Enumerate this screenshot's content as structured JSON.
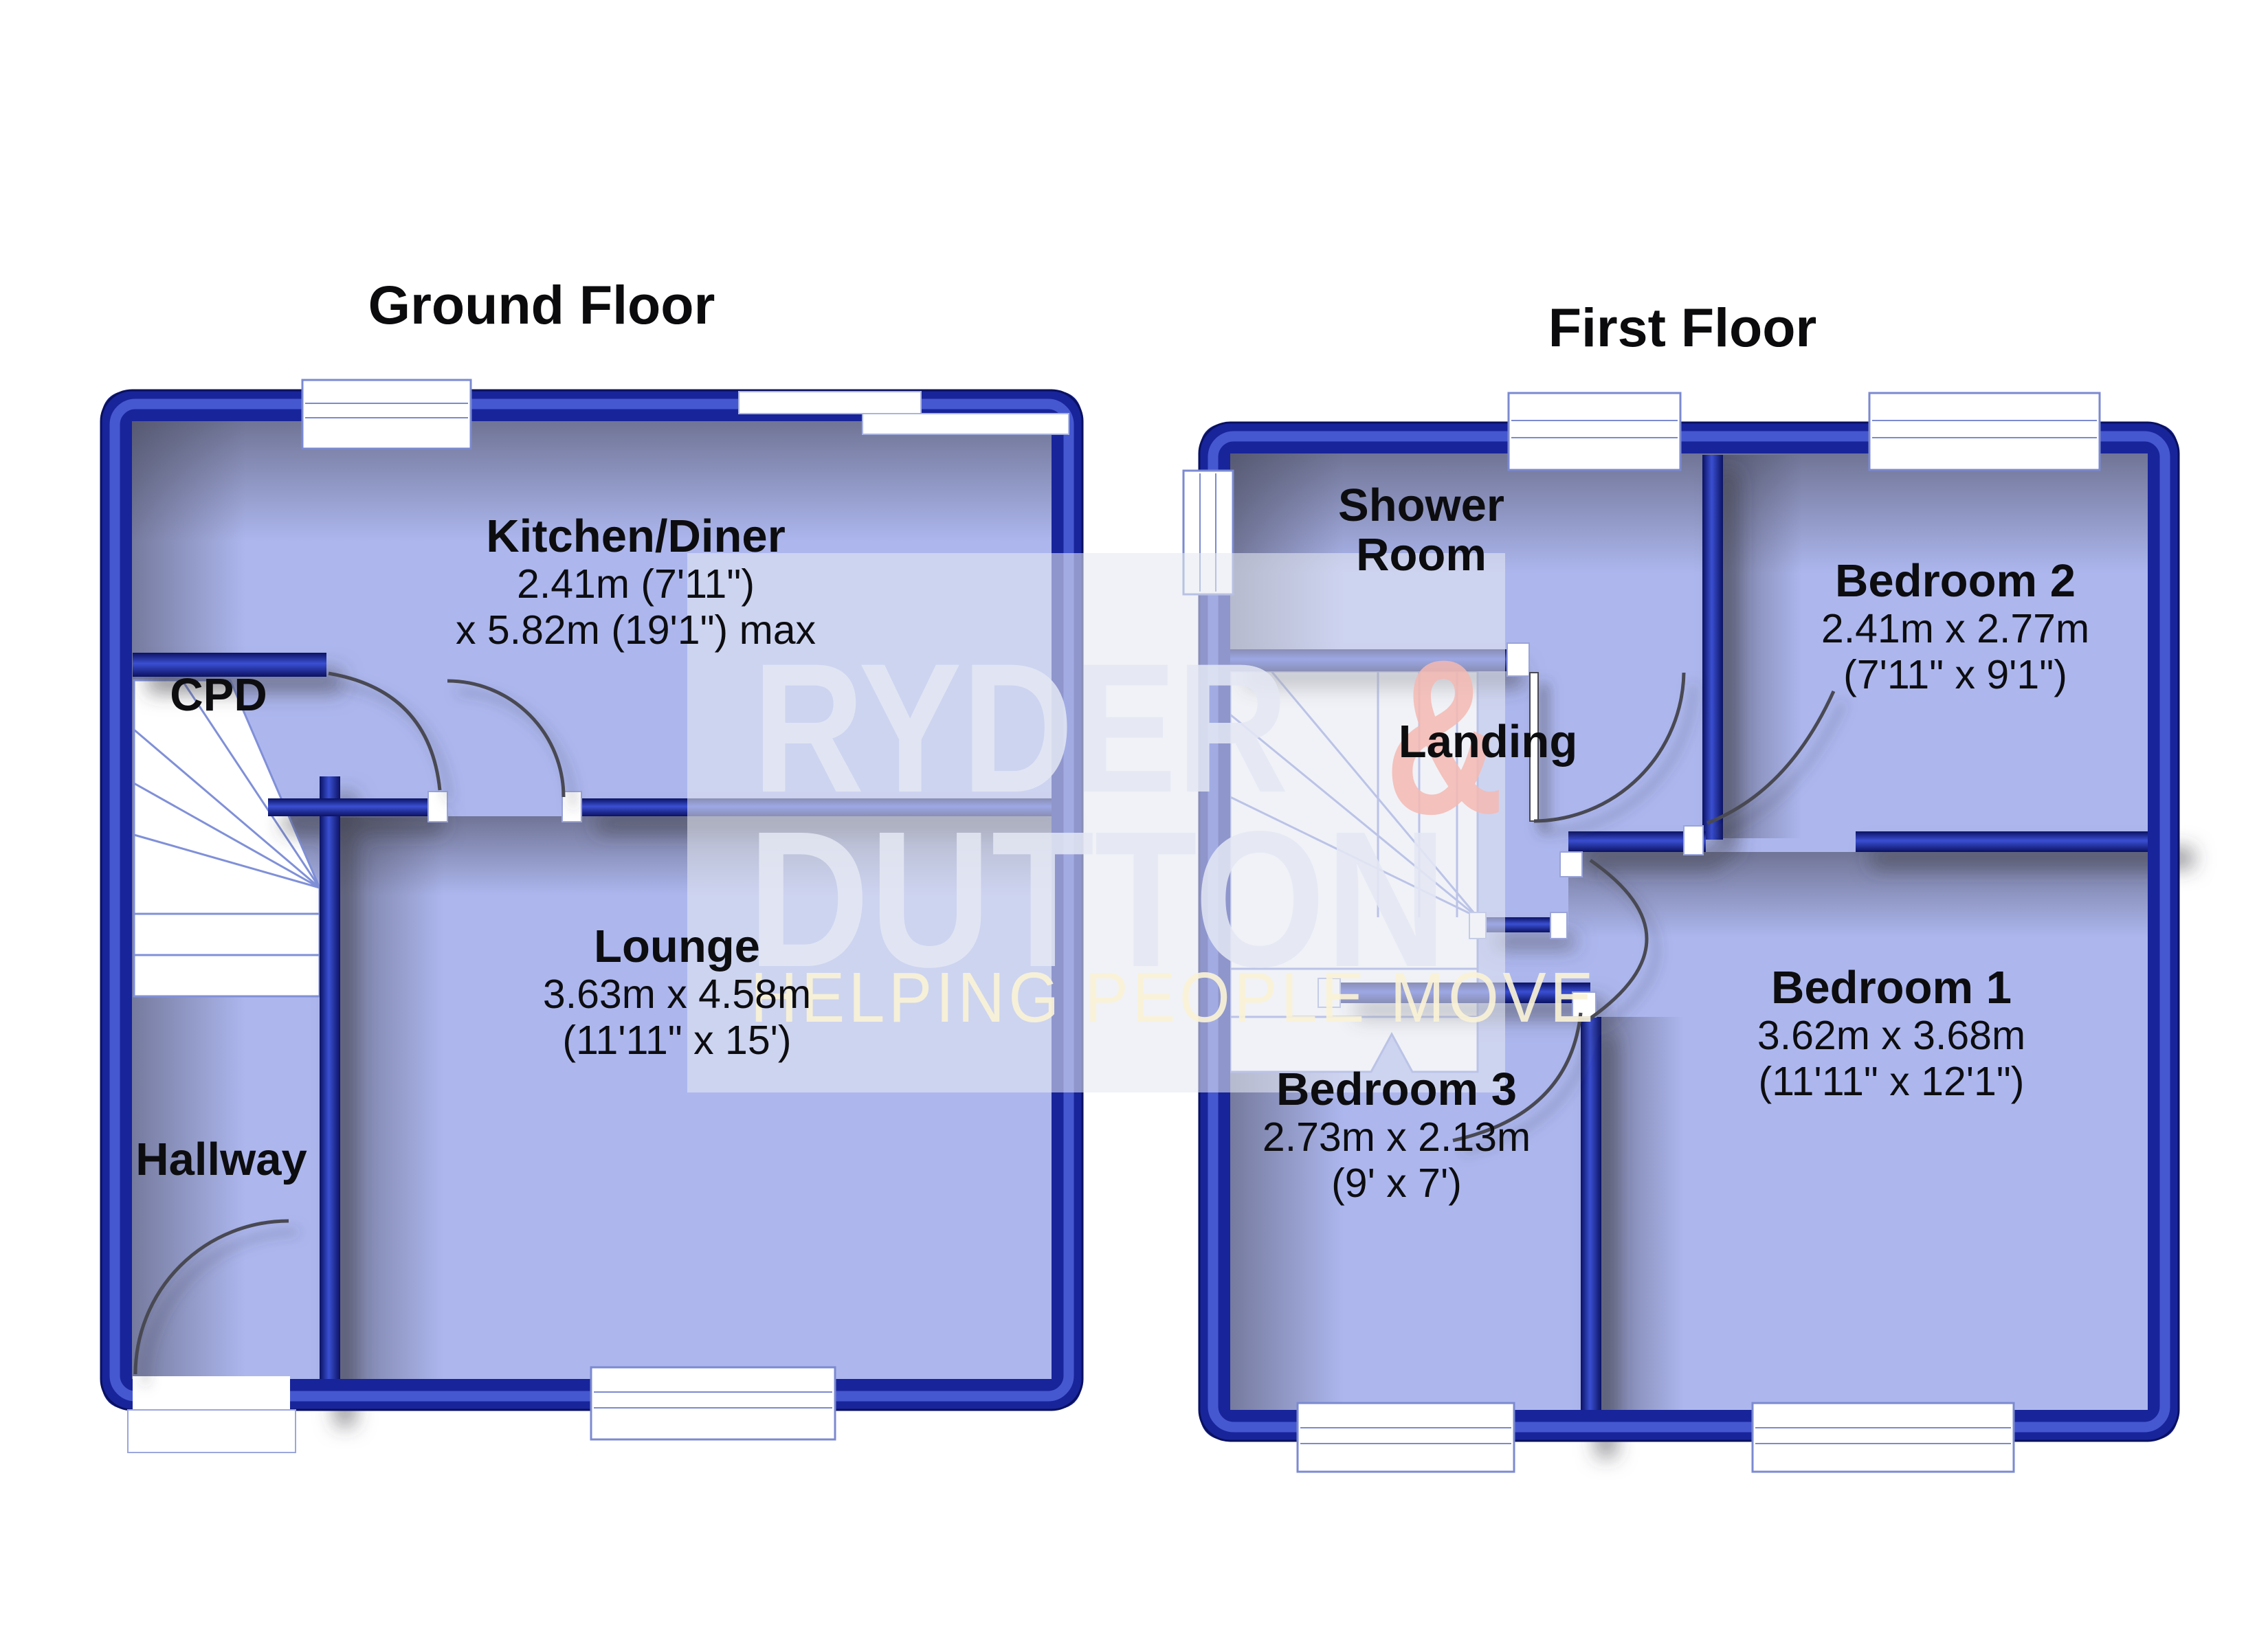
{
  "floors": [
    {
      "id": "ground",
      "title": "Ground Floor",
      "rooms": [
        {
          "id": "kitchen",
          "name": "Kitchen/Diner",
          "dim1": "2.41m (7'11\")",
          "dim2": "x 5.82m (19'1\") max"
        },
        {
          "id": "cpd",
          "name": "CPD"
        },
        {
          "id": "lounge",
          "name": "Lounge",
          "dim1": "3.63m x 4.58m",
          "dim2": "(11'11\" x 15')"
        },
        {
          "id": "hallway",
          "name": "Hallway"
        }
      ]
    },
    {
      "id": "first",
      "title": "First Floor",
      "rooms": [
        {
          "id": "shower-room",
          "name": "Shower Room"
        },
        {
          "id": "bedroom2",
          "name": "Bedroom 2",
          "dim1": "2.41m x 2.77m",
          "dim2": "(7'11\" x 9'1\")"
        },
        {
          "id": "landing",
          "name": "Landing"
        },
        {
          "id": "bedroom3",
          "name": "Bedroom 3",
          "dim1": "2.73m x 2.13m",
          "dim2": "(9' x 7')"
        },
        {
          "id": "bedroom1",
          "name": "Bedroom 1",
          "dim1": "3.62m x 3.68m",
          "dim2": "(11'11\" x 12'1\")"
        }
      ]
    }
  ],
  "watermark": {
    "brand_line1": "RYDER",
    "brand_amp": "&",
    "brand_line2": "DUTTON",
    "tagline": "HELPING PEOPLE MOVE"
  },
  "colors": {
    "wall_navy": "#1b2a9c",
    "wall_dark": "#0a1160",
    "wall_gloss": "#4b5ed6",
    "floor_fill": "#adb7ee",
    "shadow": "#3c3c46",
    "watermark_text": "#e4e7f3",
    "watermark_amp": "#f4b8b2",
    "tagline_text": "#faf2d6",
    "label_text": "#0d0d10"
  }
}
